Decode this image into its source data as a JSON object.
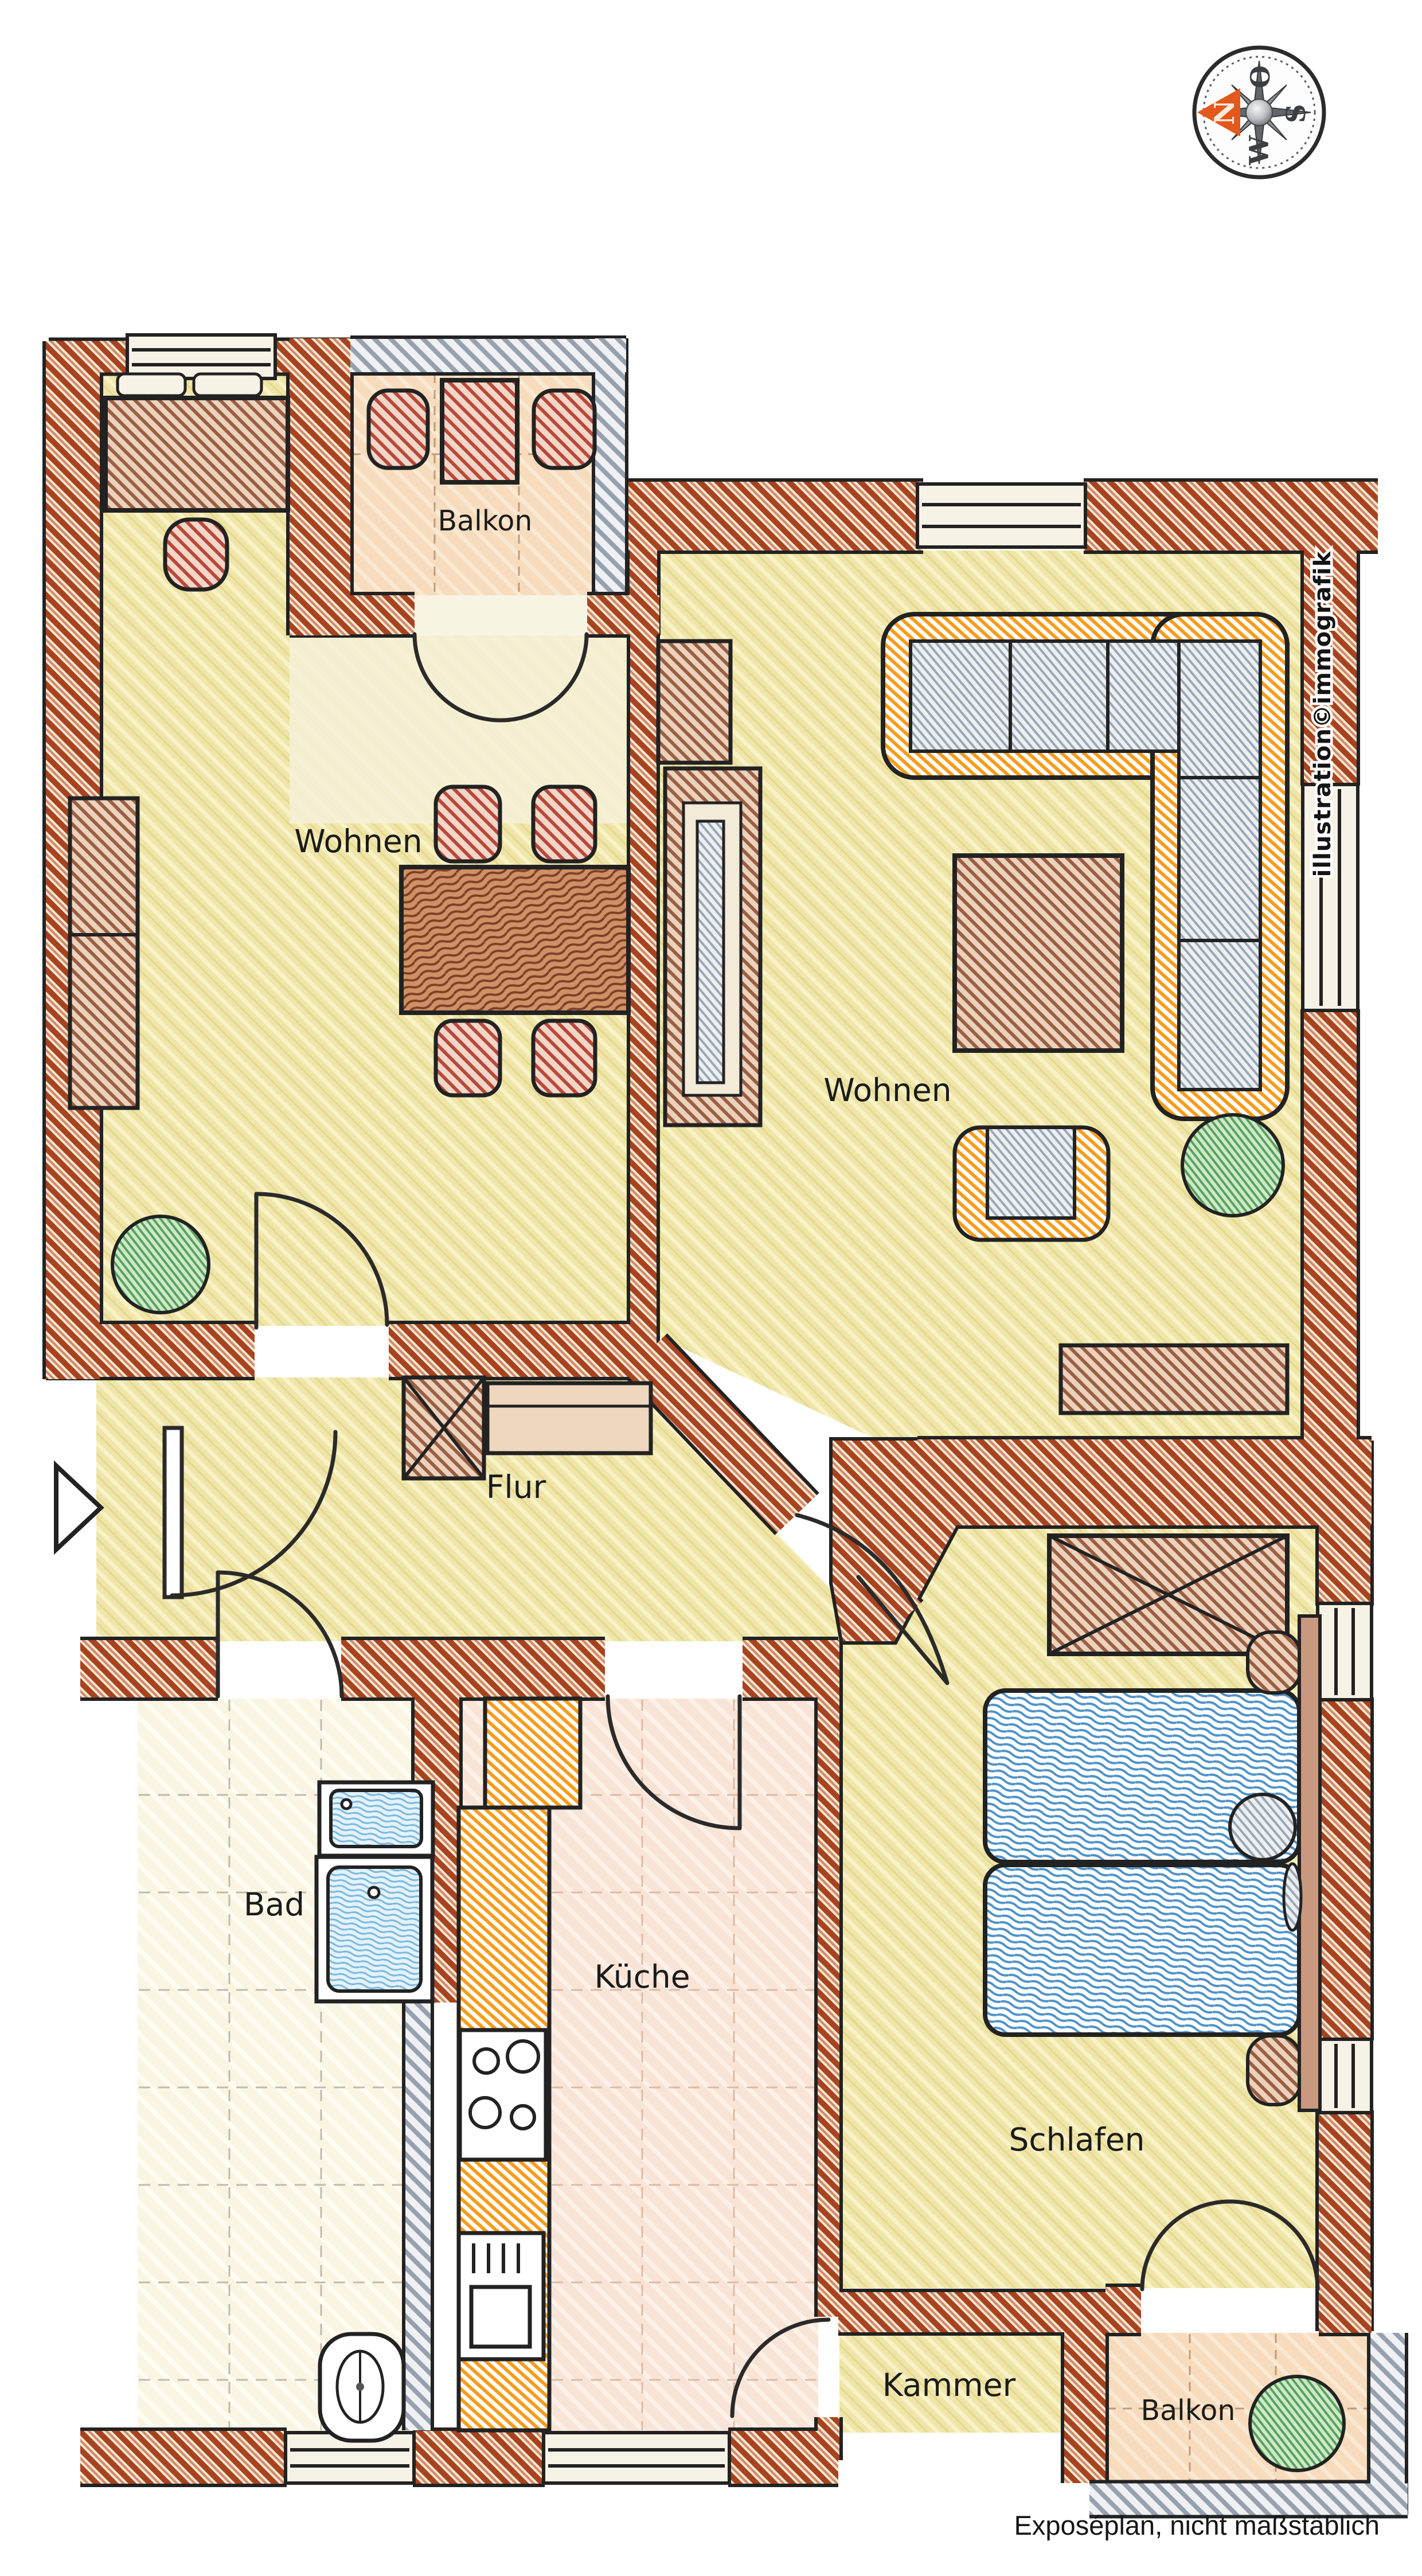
{
  "page": {
    "footer_note": "Exposéplan, nicht maßstäblich",
    "watermark": "illustration©immografik",
    "background": "#ffffff"
  },
  "compass": {
    "north": "N",
    "east": "O",
    "south": "S",
    "west": "W",
    "arrow_color": "#e4571d"
  },
  "rooms": {
    "balcony_top": {
      "label": "Balkon"
    },
    "living_left": {
      "label": "Wohnen"
    },
    "living_right": {
      "label": "Wohnen"
    },
    "hallway": {
      "label": "Flur"
    },
    "bathroom": {
      "label": "Bad"
    },
    "kitchen": {
      "label": "Küche"
    },
    "bedroom": {
      "label": "Schlafen"
    },
    "storage": {
      "label": "Kammer"
    },
    "balcony_bottom": {
      "label": "Balkon"
    }
  },
  "colors": {
    "wall_brick": "#a8431f",
    "balcony_wall_gray": "#97a1ad",
    "floor_yellow": "#efe5a8",
    "floor_peach": "#f6dcbd",
    "floor_kitchen": "#f8e4d6",
    "floor_bath": "#faf5e3",
    "furniture_brown": "#9a5f43",
    "furniture_red": "#b8493a",
    "sofa_orange": "#f79c1b",
    "sofa_gray": "#9aa6b4",
    "bed_blue": "#4e92c8",
    "fixture_blue": "#7ab8dc",
    "plant_green": "#57a25b"
  }
}
